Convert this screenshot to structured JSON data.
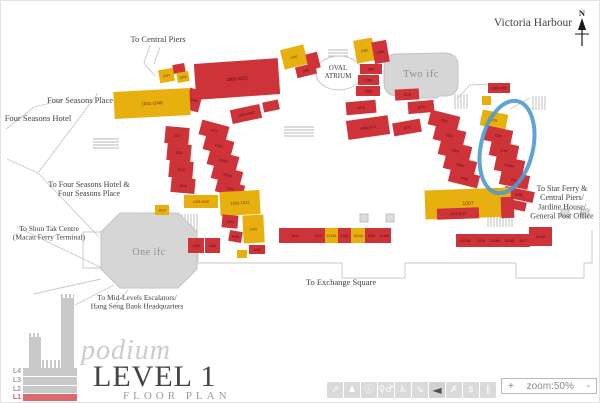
{
  "branding": {
    "podium": "podium",
    "level": "LEVEL 1",
    "floor_plan": "FLOOR PLAN"
  },
  "levels": {
    "items": [
      {
        "label": "L4",
        "active": false
      },
      {
        "label": "L3",
        "active": false
      },
      {
        "label": "L2",
        "active": false
      },
      {
        "label": "L1",
        "active": true
      }
    ]
  },
  "zoom_control": {
    "in": "+",
    "label": "zoom:50%",
    "out": "-"
  },
  "toolbar": {
    "icons": [
      {
        "name": "escalator-up-icon",
        "glyph": "⇗",
        "dark": false
      },
      {
        "name": "people-icon",
        "glyph": "♟",
        "dark": false
      },
      {
        "name": "info-icon",
        "glyph": "ⓘ",
        "dark": false
      },
      {
        "name": "restroom-icon",
        "glyph": "♀♂",
        "dark": false
      },
      {
        "name": "accessibility-icon",
        "glyph": "♿",
        "dark": false
      },
      {
        "name": "escalator-down-icon",
        "glyph": "⇘",
        "dark": false
      },
      {
        "name": "you-are-here-icon",
        "glyph": "◄",
        "dark": true
      },
      {
        "name": "lift-icon",
        "glyph": "✗",
        "dark": false
      },
      {
        "name": "atm-icon",
        "glyph": "$",
        "dark": false
      },
      {
        "name": "gates-icon",
        "glyph": "∥",
        "dark": false
      }
    ]
  },
  "map": {
    "compass_n": "N",
    "colors": {
      "red": "#ce333a",
      "yellow": "#e8b00e",
      "highlight": "#4f9ad2"
    },
    "buildings": {
      "two_ifc": "Two ifc",
      "one_ifc": "One ifc"
    },
    "labels": [
      {
        "id": "victoria-harbour",
        "text": "Victoria Harbour",
        "x": 532,
        "y": 25,
        "size": 11.5
      },
      {
        "id": "to-central-piers",
        "text": "To Central Piers",
        "x": 157,
        "y": 41,
        "size": 8.5
      },
      {
        "id": "four-seasons-place",
        "text": "Four Seasons Place",
        "x": 79,
        "y": 102,
        "size": 8.5
      },
      {
        "id": "four-seasons-hotel",
        "text": "Four Seasons Hotel",
        "x": 37,
        "y": 120,
        "size": 8.5
      },
      {
        "id": "to-four-seasons",
        "text": "To Four Seasons Hotel &\nFour Seasons Place",
        "x": 88,
        "y": 186,
        "size": 8
      },
      {
        "id": "to-shun-tak",
        "text": "To Shun Tak Centre\n(Macau Ferry Terminal)",
        "x": 48,
        "y": 230,
        "size": 7.5
      },
      {
        "id": "to-mid-levels",
        "text": "To Mid-Levels Escalators/\nHang Seng Bank Headquarters",
        "x": 136,
        "y": 299,
        "size": 7.5
      },
      {
        "id": "to-exchange-square",
        "text": "To Exchange Square",
        "x": 340,
        "y": 284,
        "size": 8.5
      },
      {
        "id": "to-star-ferry",
        "text": "To Star Ferry &\nCentral Piers/\nJardine House/\nGeneral Post Office",
        "x": 561,
        "y": 190,
        "size": 8
      },
      {
        "id": "oval-atrium",
        "text": "OVAL\nATRIUM",
        "x": 337,
        "y": 69,
        "size": 7
      }
    ],
    "shops": [
      {
        "x": 158,
        "y": 68,
        "w": 15,
        "h": 13,
        "r": -10,
        "c": "Y",
        "t": "1057"
      },
      {
        "x": 172,
        "y": 63,
        "w": 12,
        "h": 9,
        "r": -10,
        "c": "R",
        "t": ""
      },
      {
        "x": 176,
        "y": 71,
        "w": 12,
        "h": 10,
        "r": -10,
        "c": "Y",
        "t": "1058"
      },
      {
        "x": 186,
        "y": 88,
        "w": 14,
        "h": 22,
        "r": 15,
        "c": "R",
        "t": "1049"
      },
      {
        "x": 194,
        "y": 60,
        "w": 84,
        "h": 36,
        "r": -4,
        "c": "R",
        "t": "1063-1072",
        "f": 4.5
      },
      {
        "x": 113,
        "y": 89,
        "w": 76,
        "h": 27,
        "r": -3,
        "c": "Y",
        "t": "1041-1048",
        "f": 4.5
      },
      {
        "x": 281,
        "y": 46,
        "w": 24,
        "h": 20,
        "r": -14,
        "c": "Y",
        "t": "1081"
      },
      {
        "x": 295,
        "y": 64,
        "w": 20,
        "h": 11,
        "r": -14,
        "c": "R",
        "t": "1082"
      },
      {
        "x": 306,
        "y": 52,
        "w": 12,
        "h": 16,
        "r": -14,
        "c": "R",
        "t": ""
      },
      {
        "x": 230,
        "y": 106,
        "w": 30,
        "h": 14,
        "r": -12,
        "c": "R",
        "t": "1059-1062"
      },
      {
        "x": 262,
        "y": 100,
        "w": 16,
        "h": 10,
        "r": -12,
        "c": "R",
        "t": ""
      },
      {
        "x": 354,
        "y": 38,
        "w": 19,
        "h": 23,
        "r": -10,
        "c": "Y",
        "t": "1085"
      },
      {
        "x": 372,
        "y": 40,
        "w": 15,
        "h": 22,
        "r": -10,
        "c": "R",
        "t": "1086"
      },
      {
        "x": 359,
        "y": 63,
        "w": 22,
        "h": 10,
        "r": 0,
        "c": "R",
        "t": "1087"
      },
      {
        "x": 357,
        "y": 74,
        "w": 21,
        "h": 10,
        "r": 0,
        "c": "R",
        "t": "1088"
      },
      {
        "x": 355,
        "y": 85,
        "w": 24,
        "h": 10,
        "r": 0,
        "c": "R",
        "t": "1089"
      },
      {
        "x": 366,
        "y": 71,
        "w": 0,
        "h": 0,
        "r": 0,
        "c": "R",
        "t": ""
      },
      {
        "x": 394,
        "y": 88,
        "w": 24,
        "h": 11,
        "r": -3,
        "c": "R",
        "t": "1078"
      },
      {
        "x": 407,
        "y": 100,
        "w": 26,
        "h": 12,
        "r": -5,
        "c": "R",
        "t": "1079"
      },
      {
        "x": 345,
        "y": 100,
        "w": 30,
        "h": 13,
        "r": -5,
        "c": "R",
        "t": "1076"
      },
      {
        "x": 346,
        "y": 117,
        "w": 42,
        "h": 19,
        "r": -8,
        "c": "R",
        "t": "1069-1071"
      },
      {
        "x": 392,
        "y": 120,
        "w": 28,
        "h": 13,
        "r": -10,
        "c": "R",
        "t": "1073"
      },
      {
        "x": 382,
        "y": 72,
        "w": 0,
        "h": 0,
        "r": 0,
        "c": "R",
        "t": ""
      },
      {
        "x": 428,
        "y": 112,
        "w": 30,
        "h": 15,
        "r": 14,
        "c": "R",
        "t": "1091"
      },
      {
        "x": 433,
        "y": 127,
        "w": 31,
        "h": 15,
        "r": 14,
        "c": "R",
        "t": "1092"
      },
      {
        "x": 438,
        "y": 142,
        "w": 32,
        "h": 15,
        "r": 14,
        "c": "R",
        "t": "1093"
      },
      {
        "x": 443,
        "y": 157,
        "w": 32,
        "h": 14,
        "r": 14,
        "c": "R",
        "t": "1094"
      },
      {
        "x": 448,
        "y": 171,
        "w": 30,
        "h": 13,
        "r": 14,
        "c": "R",
        "t": "1095"
      },
      {
        "x": 487,
        "y": 82,
        "w": 22,
        "h": 10,
        "r": 0,
        "c": "R",
        "t": "1096-1097"
      },
      {
        "x": 481,
        "y": 95,
        "w": 9,
        "h": 9,
        "r": 0,
        "c": "Y",
        "t": ""
      },
      {
        "x": 480,
        "y": 111,
        "w": 26,
        "h": 16,
        "r": 12,
        "c": "Y",
        "t": "1101"
      },
      {
        "x": 484,
        "y": 127,
        "w": 27,
        "h": 15,
        "r": 12,
        "c": "R",
        "t": "1102"
      },
      {
        "x": 489,
        "y": 142,
        "w": 28,
        "h": 15,
        "r": 12,
        "c": "R",
        "t": "1103"
      },
      {
        "x": 494,
        "y": 157,
        "w": 29,
        "h": 15,
        "r": 12,
        "c": "R",
        "t": "1103A"
      },
      {
        "x": 499,
        "y": 172,
        "w": 29,
        "h": 14,
        "r": 12,
        "c": "R",
        "t": "1104"
      },
      {
        "x": 503,
        "y": 188,
        "w": 30,
        "h": 11,
        "r": 12,
        "c": "R",
        "t": "1105"
      },
      {
        "x": 509,
        "y": 200,
        "w": 16,
        "h": 9,
        "r": 12,
        "c": "R",
        "t": ""
      },
      {
        "x": 164,
        "y": 126,
        "w": 24,
        "h": 17,
        "r": 5,
        "c": "R",
        "t": "1021"
      },
      {
        "x": 166,
        "y": 143,
        "w": 24,
        "h": 17,
        "r": 5,
        "c": "R",
        "t": "1020"
      },
      {
        "x": 168,
        "y": 160,
        "w": 24,
        "h": 17,
        "r": 5,
        "c": "R",
        "t": "1019"
      },
      {
        "x": 170,
        "y": 177,
        "w": 24,
        "h": 15,
        "r": 5,
        "c": "R",
        "t": "1018"
      },
      {
        "x": 199,
        "y": 122,
        "w": 28,
        "h": 15,
        "r": 15,
        "c": "R",
        "t": "1022"
      },
      {
        "x": 203,
        "y": 137,
        "w": 29,
        "h": 15,
        "r": 15,
        "c": "R",
        "t": "1023"
      },
      {
        "x": 207,
        "y": 152,
        "w": 30,
        "h": 15,
        "r": 15,
        "c": "R",
        "t": "1023A"
      },
      {
        "x": 211,
        "y": 167,
        "w": 30,
        "h": 14,
        "r": 15,
        "c": "R",
        "t": "1023B"
      },
      {
        "x": 215,
        "y": 181,
        "w": 28,
        "h": 13,
        "r": 15,
        "c": "R",
        "t": "1024"
      },
      {
        "x": 183,
        "y": 194,
        "w": 34,
        "h": 13,
        "r": 0,
        "c": "Y",
        "t": "1025-1030"
      },
      {
        "x": 219,
        "y": 190,
        "w": 40,
        "h": 24,
        "r": -3,
        "c": "Y",
        "t": "1031-1032",
        "f": 4
      },
      {
        "x": 221,
        "y": 214,
        "w": 16,
        "h": 13,
        "r": 5,
        "c": "R",
        "t": "1033"
      },
      {
        "x": 228,
        "y": 230,
        "w": 13,
        "h": 11,
        "r": 10,
        "c": "R",
        "t": "1034"
      },
      {
        "x": 242,
        "y": 214,
        "w": 21,
        "h": 28,
        "r": -3,
        "c": "Y",
        "t": "1035"
      },
      {
        "x": 248,
        "y": 244,
        "w": 16,
        "h": 9,
        "r": 0,
        "c": "R",
        "t": "1036"
      },
      {
        "x": 236,
        "y": 249,
        "w": 10,
        "h": 8,
        "r": 0,
        "c": "Y",
        "t": ""
      },
      {
        "x": 154,
        "y": 204,
        "w": 14,
        "h": 10,
        "r": 0,
        "c": "Y",
        "t": "1010"
      },
      {
        "x": 187,
        "y": 237,
        "w": 16,
        "h": 15,
        "r": 0,
        "c": "R",
        "t": "1039"
      },
      {
        "x": 204,
        "y": 237,
        "w": 15,
        "h": 15,
        "r": 0,
        "c": "R",
        "t": "1040"
      },
      {
        "x": 278,
        "y": 227,
        "w": 32,
        "h": 15,
        "r": 0,
        "c": "R",
        "t": "1012"
      },
      {
        "x": 310,
        "y": 227,
        "w": 14,
        "h": 15,
        "r": 0,
        "c": "R",
        "t": "1013"
      },
      {
        "x": 324,
        "y": 227,
        "w": 13,
        "h": 15,
        "r": 0,
        "c": "Y",
        "t": "1013A"
      },
      {
        "x": 337,
        "y": 227,
        "w": 13,
        "h": 15,
        "r": 0,
        "c": "R",
        "t": "1014"
      },
      {
        "x": 350,
        "y": 227,
        "w": 14,
        "h": 15,
        "r": 0,
        "c": "Y",
        "t": "1014A"
      },
      {
        "x": 364,
        "y": 227,
        "w": 13,
        "h": 15,
        "r": 0,
        "c": "R",
        "t": "1015"
      },
      {
        "x": 377,
        "y": 227,
        "w": 13,
        "h": 15,
        "r": 0,
        "c": "R",
        "t": "1015A"
      },
      {
        "x": 455,
        "y": 233,
        "w": 18,
        "h": 13,
        "r": 0,
        "c": "R",
        "t": "1015B"
      },
      {
        "x": 473,
        "y": 233,
        "w": 14,
        "h": 13,
        "r": 0,
        "c": "R",
        "t": "1016"
      },
      {
        "x": 487,
        "y": 233,
        "w": 14,
        "h": 13,
        "r": 0,
        "c": "R",
        "t": "1016A"
      },
      {
        "x": 501,
        "y": 233,
        "w": 14,
        "h": 13,
        "r": 0,
        "c": "R",
        "t": "1016B"
      },
      {
        "x": 515,
        "y": 233,
        "w": 14,
        "h": 13,
        "r": 0,
        "c": "R",
        "t": "1017"
      },
      {
        "x": 528,
        "y": 226,
        "w": 23,
        "h": 19,
        "r": 0,
        "c": "R",
        "t": "1017A"
      },
      {
        "x": 424,
        "y": 188,
        "w": 86,
        "h": 29,
        "r": -2,
        "c": "Y",
        "t": "1007",
        "f": 5
      },
      {
        "x": 436,
        "y": 207,
        "w": 42,
        "h": 11,
        "r": -2,
        "c": "R",
        "t": "1011-1012"
      },
      {
        "x": 500,
        "y": 196,
        "w": 13,
        "h": 21,
        "r": -2,
        "c": "R",
        "t": ""
      }
    ],
    "stairs": [
      {
        "x": 92,
        "y": 137,
        "w": 26,
        "h": 11,
        "o": "h"
      },
      {
        "x": 283,
        "y": 125,
        "w": 30,
        "h": 11,
        "o": "h"
      },
      {
        "x": 327,
        "y": 48,
        "w": 20,
        "h": 12,
        "o": "h"
      },
      {
        "x": 453,
        "y": 93,
        "w": 16,
        "h": 15,
        "o": "v"
      },
      {
        "x": 531,
        "y": 95,
        "w": 16,
        "h": 14,
        "o": "v"
      },
      {
        "x": 177,
        "y": 213,
        "w": 20,
        "h": 26,
        "o": "v"
      },
      {
        "x": 253,
        "y": 216,
        "w": 10,
        "h": 22,
        "o": "v"
      },
      {
        "x": 486,
        "y": 202,
        "w": 28,
        "h": 24,
        "o": "v"
      }
    ],
    "squares": [
      {
        "x": 359,
        "y": 213
      },
      {
        "x": 385,
        "y": 213
      },
      {
        "x": 560,
        "y": 208
      },
      {
        "x": 580,
        "y": 208
      }
    ]
  }
}
